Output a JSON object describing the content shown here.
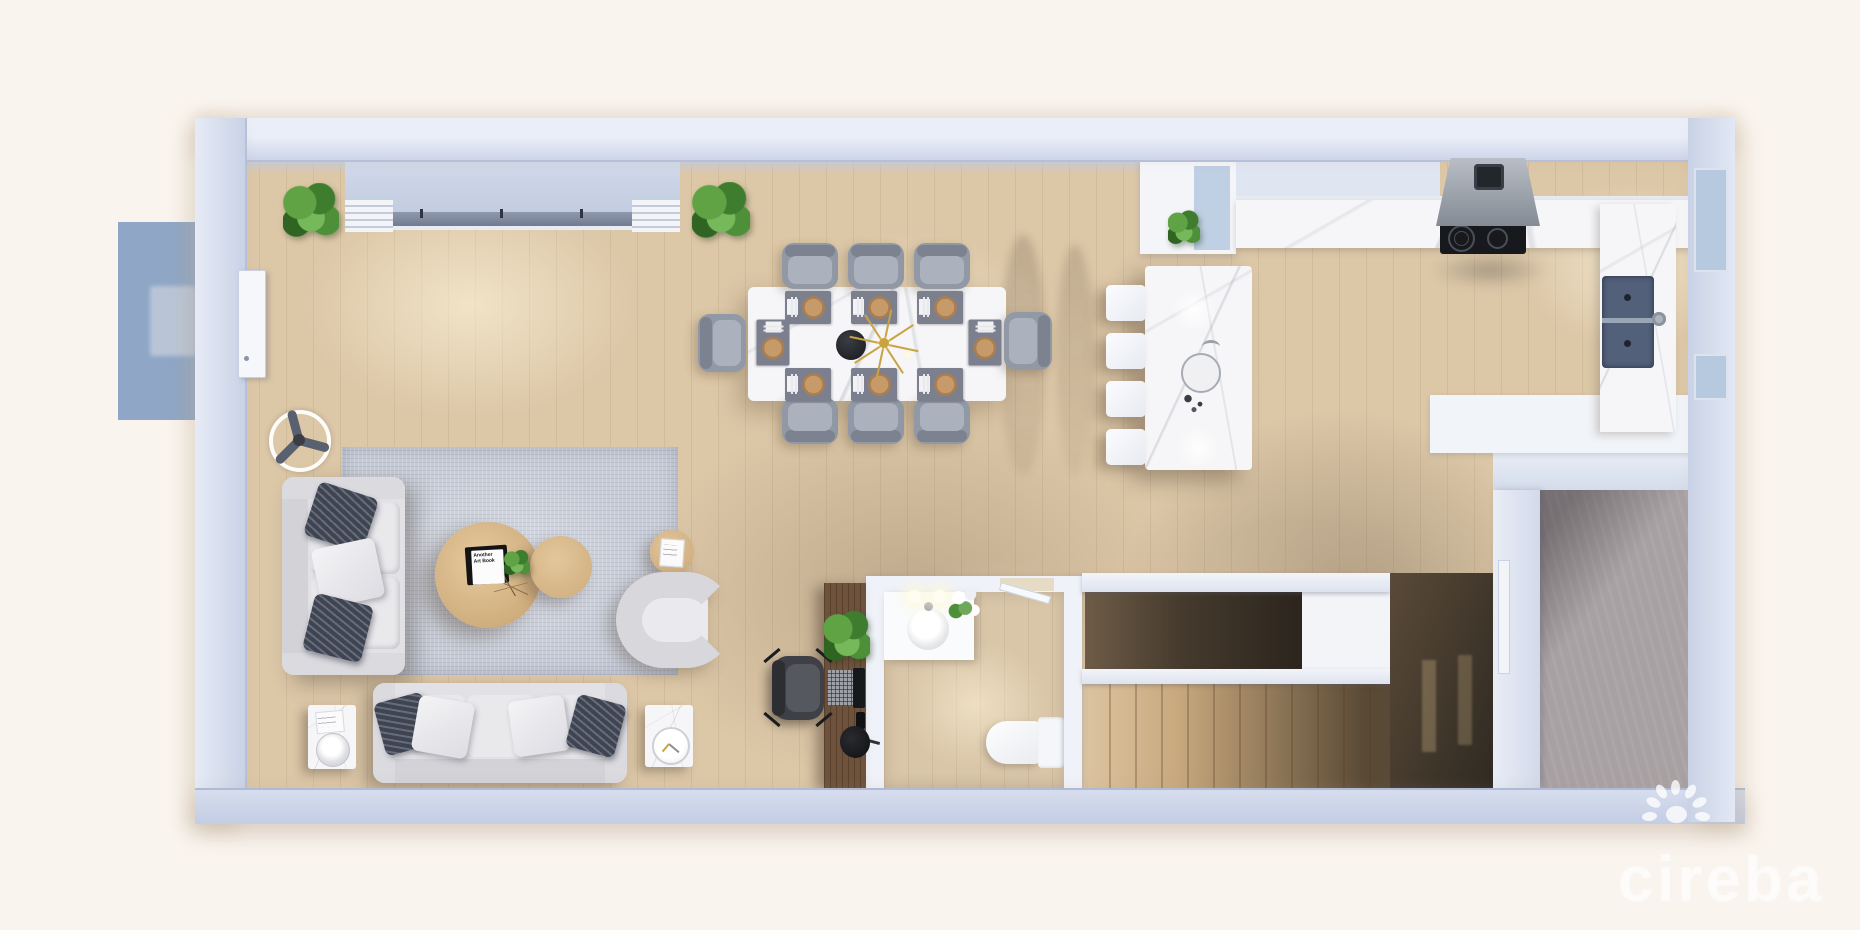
{
  "scene": {
    "type": "3D rendered floor plan, top-down view",
    "description": "Open-plan ground floor with living room, dining area, kitchen, office nook, bathroom, staircase and utility room"
  },
  "watermark": {
    "text": "cireba",
    "logo": "paw-logo"
  },
  "coffee_table_book": {
    "title": "Another Art Book"
  },
  "palette": {
    "background": "#FAF4EE",
    "wall": "#CDD5E9",
    "wall_highlight": "#EAEEF8",
    "wall_shadow": "#AEB8D0",
    "wood_floor": "#DCC7A7",
    "wood_dark": "#BA9C7B",
    "rug": "#C7CCD8",
    "marble": "#F6F6F8",
    "window_blue": "#B7C9DF",
    "entry_mat_blue": "#8FA6C6",
    "concrete": "#A8A1A3",
    "plant_green": "#5FA344",
    "chandelier_gold": "#C9A343",
    "stair_wood": "#C9A97E",
    "stair_void": "#2E2720",
    "sofa_fabric": "#E2E2E6",
    "pillow_dark": "#3E4450",
    "counter_white": "#F1F4F8",
    "sink_slate": "#52607A",
    "cooktop_black": "#17191D",
    "hood_gray": "#848B94"
  },
  "rooms": [
    {
      "id": "living-room"
    },
    {
      "id": "dining-area"
    },
    {
      "id": "kitchen"
    },
    {
      "id": "home-office-nook"
    },
    {
      "id": "bathroom"
    },
    {
      "id": "stair-hall"
    },
    {
      "id": "utility-room"
    },
    {
      "id": "entry"
    }
  ],
  "furniture": [
    "entry-mat",
    "front-door",
    "corner-plant",
    "corner-plant-2",
    "ceiling-fan",
    "three-seat-sofa",
    "two-seat-sofa",
    "accent-armchair",
    "area-rug",
    "round-coffee-table-large",
    "round-coffee-table-small",
    "round-side-table",
    "marble-side-table-left",
    "marble-side-table-right",
    "table-lamp",
    "table-clock",
    "dining-table",
    "dining-chair-x8",
    "place-setting-x8",
    "pendant-chandelier",
    "table-vase",
    "kitchen-island",
    "island-sink",
    "bar-stool-x4",
    "kitchen-cabinets",
    "kitchen-counter",
    "range-hood",
    "cooktop",
    "double-sink",
    "counter-plant",
    "desk",
    "office-chair",
    "laptop",
    "desk-plant",
    "desk-lamp",
    "bathroom-vanity",
    "vanity-sink",
    "vanity-lights",
    "vanity-flowers",
    "toilet",
    "staircase",
    "stair-railing",
    "stair-void"
  ]
}
